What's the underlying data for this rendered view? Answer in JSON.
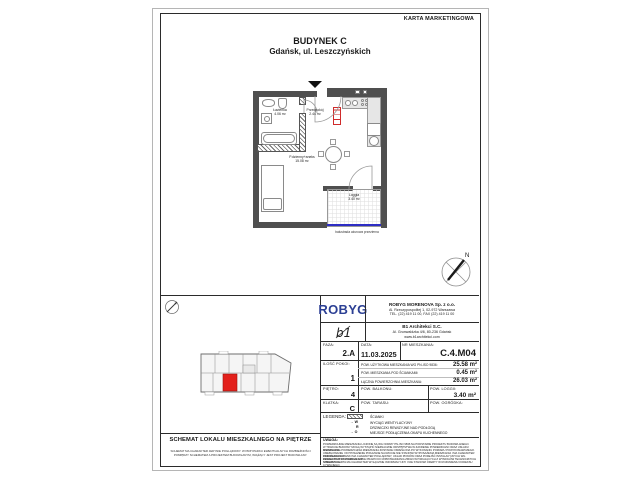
{
  "page": {
    "tag": "KARTA MARKETINGOWA",
    "title_line1": "BUDYNEK C",
    "title_line2": "Gdańsk, ul. Leszczyńskich"
  },
  "plan": {
    "rooms": [
      {
        "name": "Łazienka",
        "area": "4.06 m²"
      },
      {
        "name": "Przedpokój",
        "area": "2.44 m²"
      },
      {
        "name": "P.dzienny+aneks",
        "area": "15.08 m²"
      },
      {
        "name": "Loggia",
        "area": "3.40 m²"
      }
    ],
    "balustrade_caption": "balustrada ażurowa przezierna",
    "compass_label": "N"
  },
  "developer": {
    "logo": "ROBYG",
    "company": "ROBYG MORENOVA Sp. z o.o.",
    "address": "Al. Rzeczypospolitej 1, 02-972 Warszawa",
    "phone": "TEL. (22) 419 11 00, FAX (22) 419 11 00",
    "brand_color": "#2b3f94"
  },
  "architect": {
    "logo": "b1",
    "company": "B1 Architekci S.C.",
    "address": "Al. Grunwaldzka 4/6, 80-236 Gdańsk",
    "website": "www.b1architekci.com"
  },
  "table": {
    "faza_label": "FAZA:",
    "faza": "2.A",
    "data_label": "DATA:",
    "data": "11.03.2025",
    "nr_label": "NR MIESZKANIA:",
    "nr": "C.4.M04",
    "pokoje_label": "ILOŚĆ POKOI:",
    "pokoje": "1",
    "area_rows": [
      {
        "label": "POW. UŻYTKOWA MIESZKANIA WG PN-ISO 9836:",
        "value": "25.58 m²"
      },
      {
        "label": "POW. MIESZKANIA POD ŚCIANKAMI:",
        "value": "0.45 m²"
      },
      {
        "label": "ŁĄCZNA POWIERZCHNIA MIESZKANIA:",
        "value": "26.03 m²"
      }
    ],
    "pietro_label": "PIĘTRO:",
    "pietro": "4",
    "balkon_label": "POW. BALKONU:",
    "balkon": "",
    "loggia_label": "POW. LOGGII:",
    "loggia": "3.40 m²",
    "klatka_label": "KLATKA:",
    "klatka": "C",
    "taras_label": "POW. TARASU:",
    "taras": "",
    "ogrodek_label": "POW. OGRÓDKA:",
    "ogrodek": ""
  },
  "legend": {
    "label": "LEGENDA:",
    "items": [
      {
        "symbol": "",
        "text": "ŚCIANKI"
      },
      {
        "symbol": "→ W",
        "text": "WYCIĄG WENTYLACYJNY"
      },
      {
        "symbol": "R",
        "text": "DRZWICZKI REWIZYJNE NAD PODŁOGĄ"
      },
      {
        "symbol": "→ O",
        "text": "MIEJSCE PODŁĄCZENIA OKAPU KUCHENNEGO"
      }
    ]
  },
  "uwaga": {
    "label": "UWAGA:",
    "lines": [
      "POWIERZCHNIE MIESZKANIA LICZONE SĄ WG NORMY PN-ISO 9836 NA PODSTAWIE PROJEKTU BUDOWLANEGO.",
      "W TRAKCIE BUDOWY MOGĄ WYSTĄPIĆ NIEZNACZNE ODSTĘPSTWA W ZAKRESIE POWIERZCHNI ORAZ UKŁADU MIESZKANIA.",
      "OSTATECZNA POWIERZCHNIA MIESZKANIA ZOSTANIE OKREŚLONA PO WYKONANIU POMIARU POWYKONAWCZEGO.",
      "UMEBLOWANIE I WYPOSAŻENIE POKAZANE NA RZUCIE NIE STANOWI WYPOSAŻENIA MIESZKANIA I MA CHARAKTER PRZYKŁADOWY.",
      "ARANŻACJA ŁAZIENKI MA CHARAKTER POGLĄDOWY, UKŁAD PIONÓW ORAZ PODEJŚĆ INSTALACYJNYCH WG PROJEKTU WYKONAWCZEGO.",
      "DEWELOPER ZASTRZEGA SOBIE PRAWO DO WPROWADZANIA ZMIAN WYNIKAJĄCYCH Z WYMOGÓW TECHNICZNYCH I PRAWNYCH.",
      "NINIEJSZA KARTA MA CHARAKTER WYŁĄCZNIE INFORMACYJNY I NIE STANOWI OFERTY W ROZUMIENIU KODEKSU CYWILNEGO."
    ]
  },
  "schemat": {
    "title": "SCHEMAT LOKALU MIESZKALNEGO NA PIĘTRZE",
    "disclaimer_line1": "SCHEMAT MA CHARAKTER JEDYNIE POGLĄDOWY. W PRZYPADKU EWENTUALNYCH ROZBIEŻNOŚCI",
    "disclaimer_line2": "POMIĘDZY SCHEMATEM A PROJEKTEM BUDOWLANYM, WIĄŻĄCY JEST PROJEKT BUDOWLANY.",
    "unit_highlight_color": "#e3201b"
  }
}
